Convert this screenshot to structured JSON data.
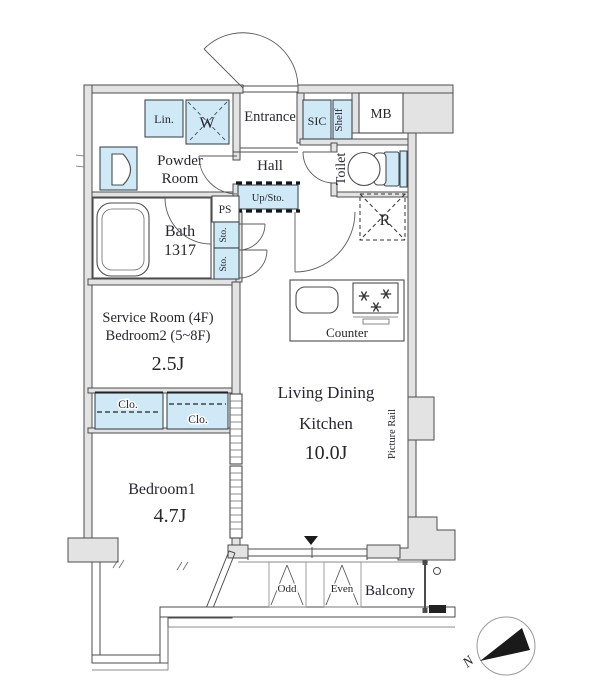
{
  "colors": {
    "fixture_blue": "#cfe9f6",
    "wall_fill": "#e3e3e3",
    "wall_line": "#4c4c4c",
    "text": "#26262e",
    "north_arrow": "#1a1a1a"
  },
  "rooms": {
    "entrance": "Entrance",
    "sic": "SIC",
    "shelf": "Shelf",
    "mb": "MB",
    "linen": "Lin.",
    "washer": "W",
    "powder_line1": "Powder",
    "powder_line2": "Room",
    "hall": "Hall",
    "toilet": "Toilet",
    "up_storage": "Up/Sto.",
    "ps": "PS",
    "storage1": "Sto.",
    "storage2": "Sto.",
    "bath": "Bath",
    "bath_size": "1317",
    "refrigerator": "R",
    "counter": "Counter",
    "service_line1": "Service Room (4F)",
    "service_line2": "Bedroom2 (5~8F)",
    "service_area": "2.5J",
    "ldk_line1": "Living Dining",
    "ldk_line2": "Kitchen",
    "ldk_area": "10.0J",
    "picture_rail": "Picture Rail",
    "closet1": "Clo.",
    "closet2": "Clo.",
    "bedroom1": "Bedroom1",
    "bedroom1_area": "4.7J",
    "balcony": "Balcony",
    "hatch_odd": "Odd",
    "hatch_even": "Even"
  },
  "compass": {
    "north": "N"
  }
}
